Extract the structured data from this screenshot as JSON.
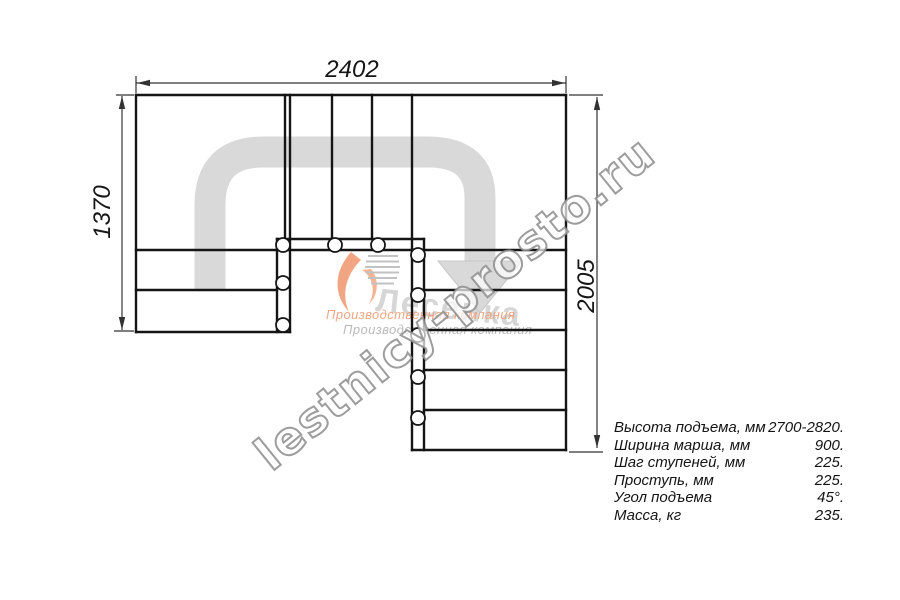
{
  "drawing": {
    "title_semantic": "staircase plan view",
    "dim_top": "2402",
    "dim_left": "1370",
    "dim_right": "2005"
  },
  "specs": [
    {
      "label": "Высота подъема, мм",
      "value": "2700-2820."
    },
    {
      "label": "Ширина марша, мм",
      "value": "900."
    },
    {
      "label": "Шаг ступеней, мм",
      "value": "225."
    },
    {
      "label": "Проступь, мм",
      "value": "225."
    },
    {
      "label": "Угол подъема",
      "value": "45°."
    },
    {
      "label": "Масса, кг",
      "value": "235."
    }
  ],
  "watermark": {
    "site": "lestnicy-prosto.ru",
    "brand": "Лесенка",
    "tagline_orange": "Производственная компания",
    "tagline_gray": "Производственная компания"
  },
  "colors": {
    "line": "#151515",
    "dimension_line": "#333333",
    "arrow_fill": "#d9d9d9",
    "logo_orange": "#ef8f63",
    "watermark_gray": "#8f8f8f"
  }
}
